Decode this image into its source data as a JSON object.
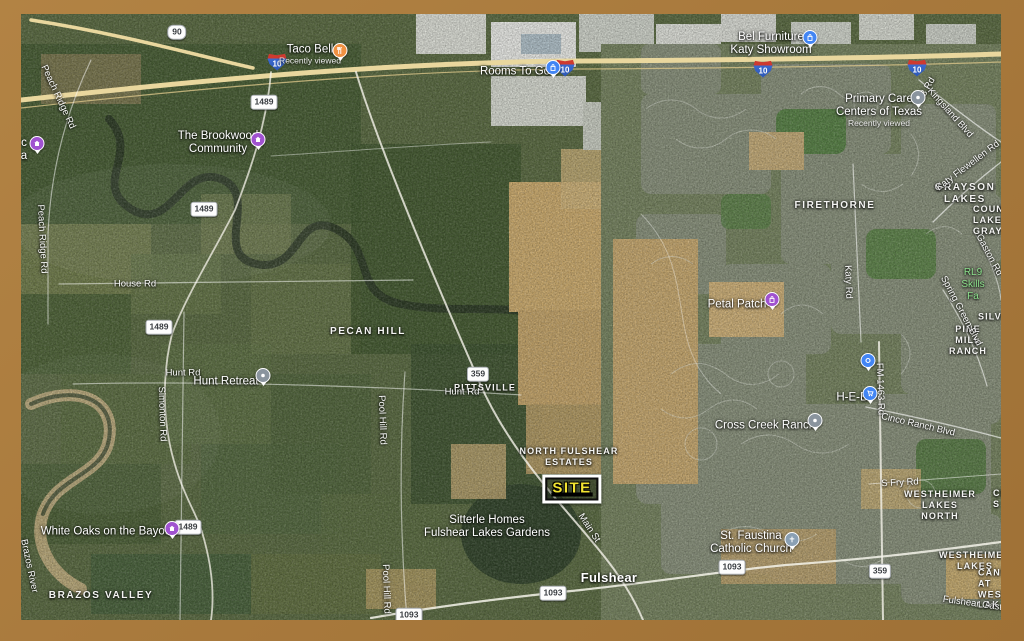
{
  "frame": {
    "color": "#A97A3D"
  },
  "site_sign": {
    "label": "SITE",
    "text_color": "#F2E431"
  },
  "towns": {
    "fulshear": "Fulshear"
  },
  "pois": {
    "taco_bell": {
      "label": "Taco Bell",
      "sub": "Recently viewed"
    },
    "rooms_to_go": {
      "label": "Rooms To Go"
    },
    "bel_furniture": {
      "label": "Bel Furniture\nKaty Showroom"
    },
    "primary_care": {
      "label": "Primary Care\nCenters of Texas",
      "sub": "Recently viewed"
    },
    "brookwood": {
      "label": "The Brookwood\nCommunity"
    },
    "edge_listing": {
      "label": "c\na"
    },
    "hunt_retreat": {
      "label": "Hunt Retreat"
    },
    "petal_patch": {
      "label": "Petal Patch"
    },
    "white_oaks": {
      "label": "White Oaks on the Bayou"
    },
    "cross_creek_ranch": {
      "label": "Cross Creek Ranch"
    },
    "heb": {
      "label": "H-E-B"
    },
    "st_faustina": {
      "label": "St. Faustina\nCatholic Church"
    },
    "sitterle_homes": {
      "label": "Sitterle Homes\nFulshear Lakes Gardens"
    }
  },
  "districts": {
    "pecan_hill": "PECAN HILL",
    "pittsville": "PITTSVILLE",
    "north_fulshear_estates": "NORTH FULSHEAR\nESTATES",
    "brazos_valley": "BRAZOS VALLEY",
    "firethorne": "FIRETHORNE",
    "grayson_lakes": "GRAYSON LAKES",
    "country_lakes_grayson": "COUN\nLAKES\nGRAYSON",
    "pine_mill_ranch": "PINE MILL\nRANCH",
    "silver_ranch": "SILVE",
    "westheimer_lakes_north": "WESTHEIMER\nLAKES NORTH",
    "cinco_fragment": "CI\nS",
    "westheimer_lakes": "WESTHEIMER\nLAKES",
    "canyon_at_west": "CANYON\nAT WEST\nLAK"
  },
  "parks": {
    "rl9_skills": "RL9 Skills Fa"
  },
  "roads": {
    "peach_ridge": "Peach Ridge Rd",
    "house": "House Rd",
    "simonton": "Simonton Rd",
    "hunt": "Hunt Rd",
    "pool_hill": "Pool Hill Rd",
    "main_st": "Main St",
    "brazos_river": "Brazos River",
    "katy_rd": "Katy Rd",
    "fm_1463": "FM 1463 Rd",
    "kingsland": "Kingsland Blvd",
    "katy_flewellen": "Katy Flewellen Rd",
    "cinco_ranch": "Cinco Ranch Blvd",
    "spring_green": "Spring Green Blvd",
    "s_fry": "S Fry Rd",
    "gaston": "Gaston Rd",
    "fulshear_gaston": "Fulshear Gasto",
    "rd3_fragment": "3 Rd"
  },
  "shields": {
    "us90": "90",
    "i10": "10",
    "fm1489": "1489",
    "fm1093": "1093",
    "fm359": "359"
  },
  "colors": {
    "poi_orange": "#F09142",
    "poi_blue": "#4285F4",
    "poi_purple": "#A052D0",
    "poi_gray": "#8A949E",
    "church_blue_gray": "#8AA0B4",
    "park_label_green": "#8CE08C",
    "highway_yellow": "#E9D79E"
  },
  "icons": {
    "restaurant-icon": "fork and knife",
    "shopping-bag-icon": "shopping bag",
    "cart-icon": "shopping cart",
    "home-icon": "house",
    "church-icon": "cross",
    "dot-icon": "dot",
    "ring-icon": "ring"
  }
}
